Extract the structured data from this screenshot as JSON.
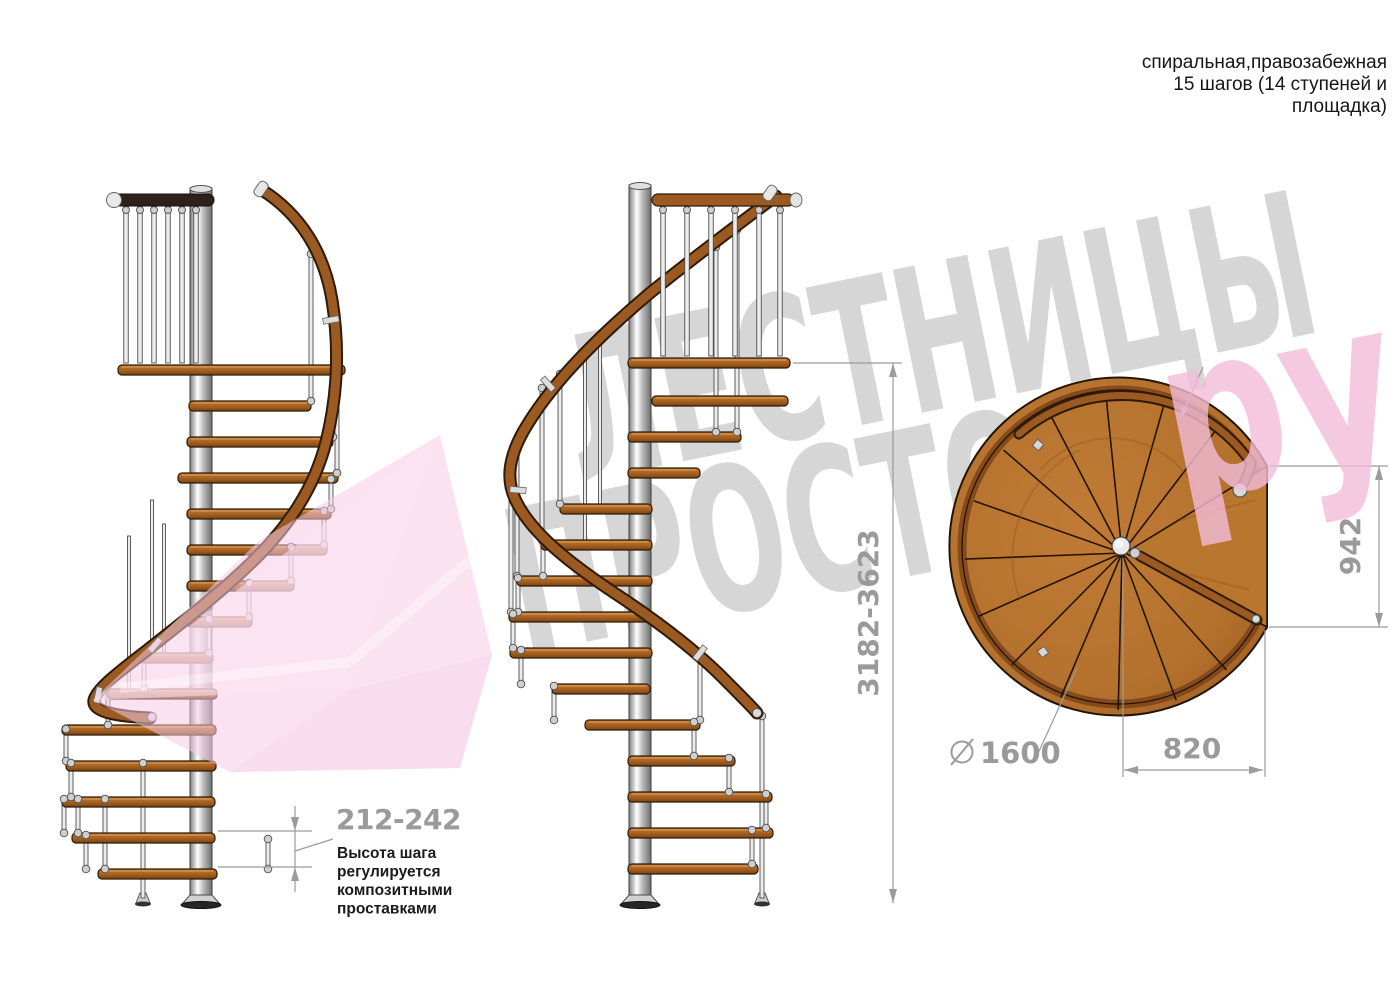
{
  "header_note": {
    "line1": "спиральная,правозабежная",
    "line2": "15 шагов (14 ступеней и",
    "line3": "площадка)"
  },
  "watermark": {
    "word1": "ЛЕСТНИЦЫ",
    "word2": "ПРОСТО.",
    "suffix": "ру"
  },
  "dimensions": {
    "total_height": "3182-3623",
    "step_height": "212-242",
    "landing_depth": "942",
    "landing_width": "820",
    "diameter_value": "1600"
  },
  "step_note": {
    "line1": "Высота шага",
    "line2": "регулируется",
    "line3": "композитными",
    "line4": "проставками"
  },
  "colors": {
    "wood": "#a4601f",
    "wood_dark": "#2e1a06",
    "steel": "#c9c9c9",
    "dim_gray": "#9a9a9a",
    "watermark_gray": "#d6d6d6",
    "watermark_pink": "#f3bcd9",
    "text_black": "#1b1b1b"
  }
}
